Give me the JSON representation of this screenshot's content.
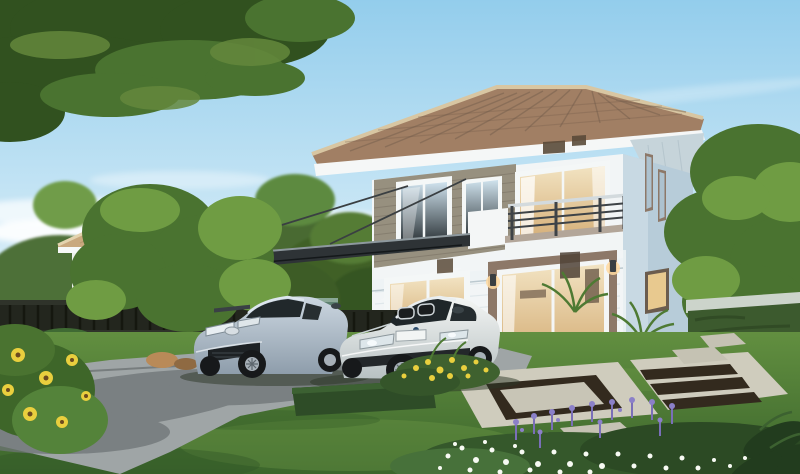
{
  "meta": {
    "title": "Two-story suburban house exterior rendering",
    "type": "architectural-visualization",
    "width_px": 800,
    "height_px": 474,
    "visible_text": "none"
  },
  "scene": {
    "description": "Photorealistic rendering of a modern two-story house with terracotta hip roof, second-floor balcony, glass carport canopy, two sedans parked on a concrete driveway, landscaped lawn with stone patio, flower beds, fences and neighboring houses under a blue sky.",
    "objects": [
      {
        "name": "sky",
        "detail": "clear blue sky with soft white clouds near horizon"
      },
      {
        "name": "tree-canopy-overhang",
        "detail": "dark green branch overhanging top-left corner"
      },
      {
        "name": "neighbor-house-left",
        "detail": "white two-story house, tan tiled hip roof, behind dark picket fence"
      },
      {
        "name": "neighbor-house-right",
        "detail": "white house with terracotta roof trim behind trees"
      },
      {
        "name": "main-house",
        "detail": "white/grey two-story home, brown tiled hip roof, grey siding accent band"
      },
      {
        "name": "balcony",
        "detail": "second-floor balcony, white parapet, dark posts with light rails"
      },
      {
        "name": "carport-canopy",
        "detail": "cantilevered dark glass awning on cables over parked cars"
      },
      {
        "name": "sliding-glass-door",
        "detail": "large first-floor slider, taupe surround, warm lit interior, two sconces"
      },
      {
        "name": "sedan-silver",
        "detail": "silver-blue sedan parked left"
      },
      {
        "name": "sedan-white",
        "detail": "white sedan with twin kidney grille parked right"
      },
      {
        "name": "driveway",
        "detail": "grey concrete drive with tree shadows"
      },
      {
        "name": "lawn",
        "detail": "trimmed green grass"
      },
      {
        "name": "patio",
        "detail": "light stone slabs with dark pebble inlay strips"
      },
      {
        "name": "flower-bed",
        "detail": "white daisies and purple spikes, bottom right"
      },
      {
        "name": "red-flower-hedge",
        "detail": "red blooms along vine-covered garden wall"
      },
      {
        "name": "sunflower-bush",
        "detail": "yellow flowers bottom-left"
      },
      {
        "name": "garden-wall",
        "detail": "teal-green wall and capped masonry wall"
      },
      {
        "name": "metal-fence",
        "detail": "dark vertical-bar fence along left boundary"
      }
    ]
  },
  "colors": {
    "sky_top": "#93cdec",
    "sky_mid": "#c2e3f4",
    "sky_bottom": "#eaf6fc",
    "cloud": "#ffffff",
    "foliage_dark": "#31511f",
    "foliage_mid": "#4a7330",
    "foliage_light": "#6f9c43",
    "roof_tile": "#a17f64",
    "roof_ridge": "#d8c6a2",
    "roof_tan": "#c9a87e",
    "fascia": "#f5f7f7",
    "soffit": "#c6d4da",
    "wall_white": "#f2f5f6",
    "siding_band": "#97907f",
    "side_wall_blue": "#b7ccd9",
    "door_surround": "#8d7868",
    "door_wood": "#8a6747",
    "interior_warm": "#f2e3c2",
    "interior_deep": "#d2a970",
    "glass_dark": "#232a2d",
    "glass_sky": "#cfe2ed",
    "rail_dark": "#3e4347",
    "rail_light": "#d3dadd",
    "canopy_glass": "#2e3336",
    "garden_wall_teal": "#5d8070",
    "fence_dark": "#23261e",
    "wall_cap": "#ccd4cb",
    "vine_wall": "#3c5a2e",
    "lawn_light": "#628f40",
    "lawn_dark": "#3c662c",
    "driveway": "#9fa5a6",
    "driveway_shadow": "#6e7476",
    "patio_slab": "#cfccbd",
    "patio_inlay": "#332a1e",
    "rock": "#b98a58",
    "flower_white": "#f7faf3",
    "flower_purple": "#8b80c8",
    "flower_red": "#c4505a",
    "flower_yellow": "#e9cf3e",
    "car1_top": "#ccd7e1",
    "car1_bottom": "#8e9dab",
    "car2_top": "#f4f6f4",
    "car2_bottom": "#b7c0c2",
    "tire": "#17191b",
    "rim": "#a7b0b8",
    "trunk": "#6b5136"
  }
}
